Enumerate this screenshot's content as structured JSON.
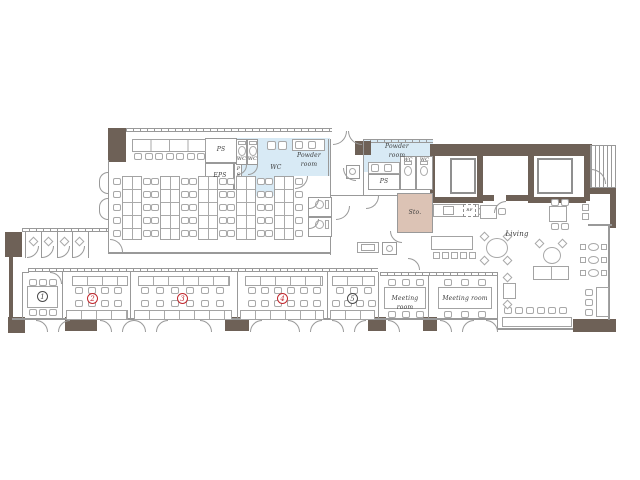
{
  "plan": {
    "labels": {
      "ps_shaft": "PS",
      "eps_shaft": "EPS",
      "ps_side_shaft": "PS",
      "wc_left_booth_1": "WC",
      "wc_left_booth_2": "WC",
      "wc_left_area": "WC",
      "powder_room_left": "Powder room",
      "powder_room_right": "Powder room",
      "ps_right_shaft": "PS",
      "wc_right_booth_1": "WC",
      "wc_right_booth_2": "WC",
      "storage": "Sto.",
      "refrigerator": "RF",
      "living": "Living",
      "meeting_room_left": "Meeting room",
      "meeting_room_right": "Meeting room"
    },
    "room_numbers": [
      {
        "value": "1",
        "style": "dark"
      },
      {
        "value": "2",
        "style": "red"
      },
      {
        "value": "3",
        "style": "red"
      },
      {
        "value": "4",
        "style": "red"
      },
      {
        "value": "5",
        "style": "dark"
      }
    ],
    "colors": {
      "wall": "#6e6157",
      "wet_area": "#d8eaf5",
      "storage": "#dcc3b5",
      "number_red": "#c1272d",
      "number_dark": "#4a4a4a",
      "line": "#999999"
    }
  }
}
